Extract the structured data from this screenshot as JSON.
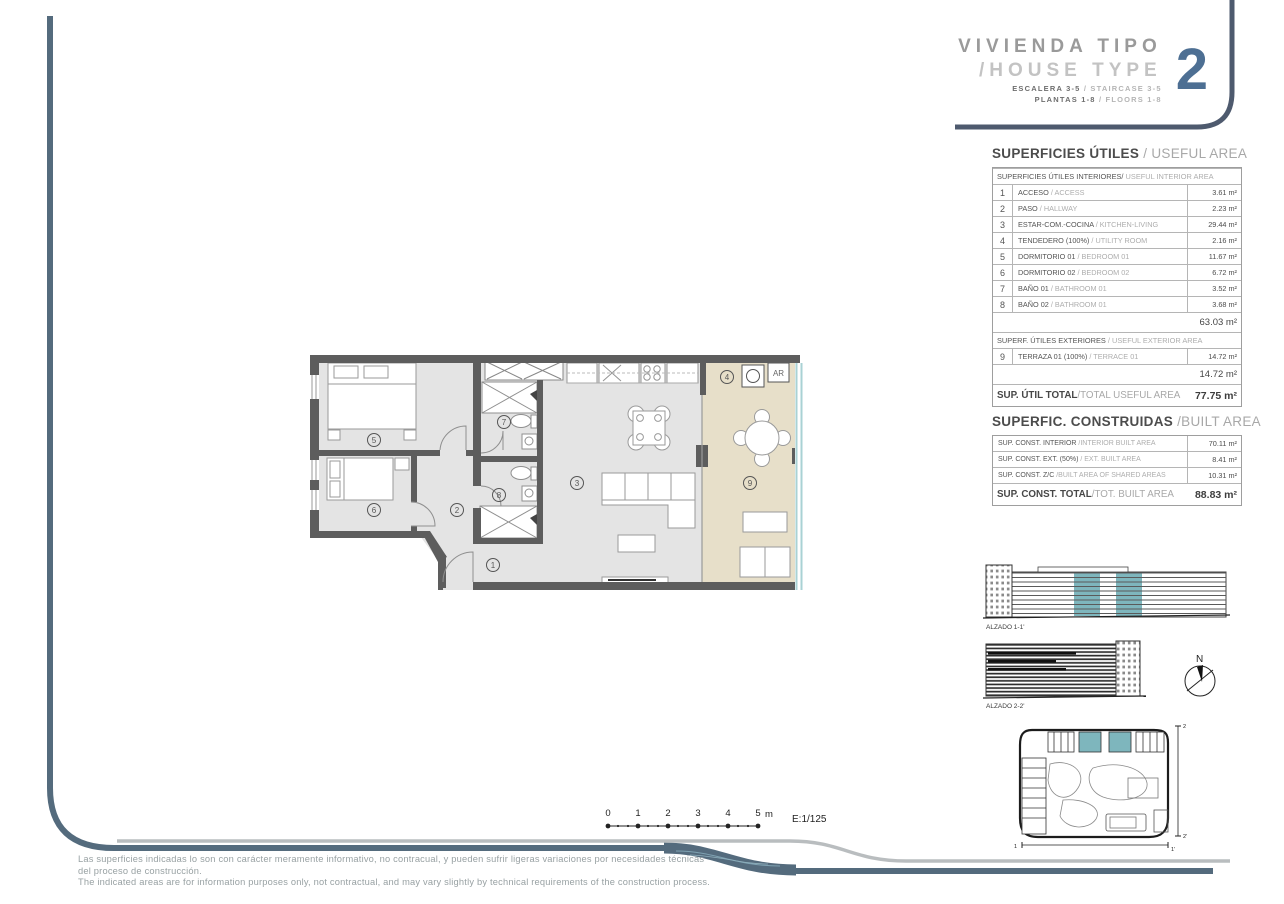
{
  "title_block": {
    "line1": "VIVIENDA TIPO",
    "line2": "/HOUSE TYPE",
    "number": "2",
    "sub1_es": "ESCALERA 3-5",
    "sub1_sl": "/",
    "sub1_en": "STAIRCASE 3-5",
    "sub2_es": "PLANTAS 1-8",
    "sub2_sl": "/",
    "sub2_en": "FLOORS 1-8"
  },
  "useful_area": {
    "title_es": "SUPERFICIES ÚTILES ",
    "title_en": "/ USEFUL AREA",
    "interior_header_es": "SUPERFICIES ÚTILES INTERIORES/",
    "interior_header_en": " USEFUL INTERIOR AREA",
    "interior_rows": [
      {
        "num": "1",
        "es": "ACCESO ",
        "en": "/ ACCESS",
        "value": "3.61 m²"
      },
      {
        "num": "2",
        "es": "PASO ",
        "en": "/ HALLWAY",
        "value": "2.23 m²"
      },
      {
        "num": "3",
        "es": "ESTAR-COM.-COCINA ",
        "en": "/ KITCHEN-LIVING",
        "value": "29.44 m²"
      },
      {
        "num": "4",
        "es": "TENDEDERO (100%) ",
        "en": "/ UTILITY ROOM",
        "value": "2.16 m²"
      },
      {
        "num": "5",
        "es": "DORMITORIO 01 ",
        "en": "/ BEDROOM 01",
        "value": "11.67 m²"
      },
      {
        "num": "6",
        "es": "DORMITORIO 02 ",
        "en": "/ BEDROOM 02",
        "value": "6.72 m²"
      },
      {
        "num": "7",
        "es": "BAÑO 01 ",
        "en": "/ BATHROOM 01",
        "value": "3.52 m²"
      },
      {
        "num": "8",
        "es": "BAÑO 02 ",
        "en": "/ BATHROOM 01",
        "value": "3.68 m²"
      }
    ],
    "interior_subtotal": "63.03 m²",
    "exterior_header_es": "SUPERF. ÚTILES EXTERIORES ",
    "exterior_header_en": "/ USEFUL EXTERIOR AREA",
    "exterior_rows": [
      {
        "num": "9",
        "es": "TERRAZA 01 (100%) ",
        "en": "/ TERRACE 01",
        "value": "14.72 m²"
      }
    ],
    "exterior_subtotal": "14.72 m²",
    "total_es": "SUP. ÚTIL TOTAL",
    "total_en": "/TOTAL USEFUL AREA",
    "total_value": "77.75 m²"
  },
  "built_area": {
    "title_es": "SUPERFIC. CONSTRUIDAS ",
    "title_en": "/BUILT AREA",
    "rows": [
      {
        "es": "SUP. CONST. INTERIOR ",
        "en": "/INTERIOR BUILT AREA",
        "value": "70.11 m²"
      },
      {
        "es": "SUP. CONST. EXT. (50%) ",
        "en": "/ EXT. BUILT AREA",
        "value": "8.41 m²"
      },
      {
        "es": "SUP. CONST. Z/C ",
        "en": "/BUILT AREA OF SHARED AREAS",
        "value": "10.31 m²"
      }
    ],
    "total_es": "SUP. CONST. TOTAL",
    "total_en": "/TOT. BUILT AREA",
    "total_value": "88.83 m²"
  },
  "floor_plan": {
    "numbers": [
      "1",
      "2",
      "3",
      "4",
      "5",
      "6",
      "7",
      "8",
      "9"
    ],
    "ar_label": "AR"
  },
  "elevations": {
    "alzado1": "ALZADO 1-1'",
    "alzado2": "ALZADO 2-2'",
    "north": "N"
  },
  "site_plan": {
    "m2_top": "2",
    "m2_bottom": "2'",
    "m1_left": "1",
    "m1_right": "1'"
  },
  "scale_bar": {
    "ticks": [
      "0",
      "1",
      "2",
      "3",
      "4",
      "5"
    ],
    "unit": "m",
    "ratio": "E:1/125"
  },
  "disclaimer": {
    "es_line1": "Las superficies indicadas lo son con carácter meramente informativo, no contracual, y pueden sufrir ligeras variaciones por necesidades técnicas",
    "es_line2": "del proceso de construcción.",
    "en_line": "The indicated areas are for information purposes only, not contractual, and may vary slightly by technical requirements of the construction process."
  },
  "colors": {
    "frame_blue": "#546b7d",
    "title_navy": "#4e5a6e",
    "accent_number": "#4d6f93",
    "teal_highlight": "#7eb6bd",
    "terrace_beige": "#e7dfc9",
    "wall_grey": "#5d5d5d",
    "floor_grey": "#e4e4e4",
    "band_grey": "#b9bdbf"
  }
}
